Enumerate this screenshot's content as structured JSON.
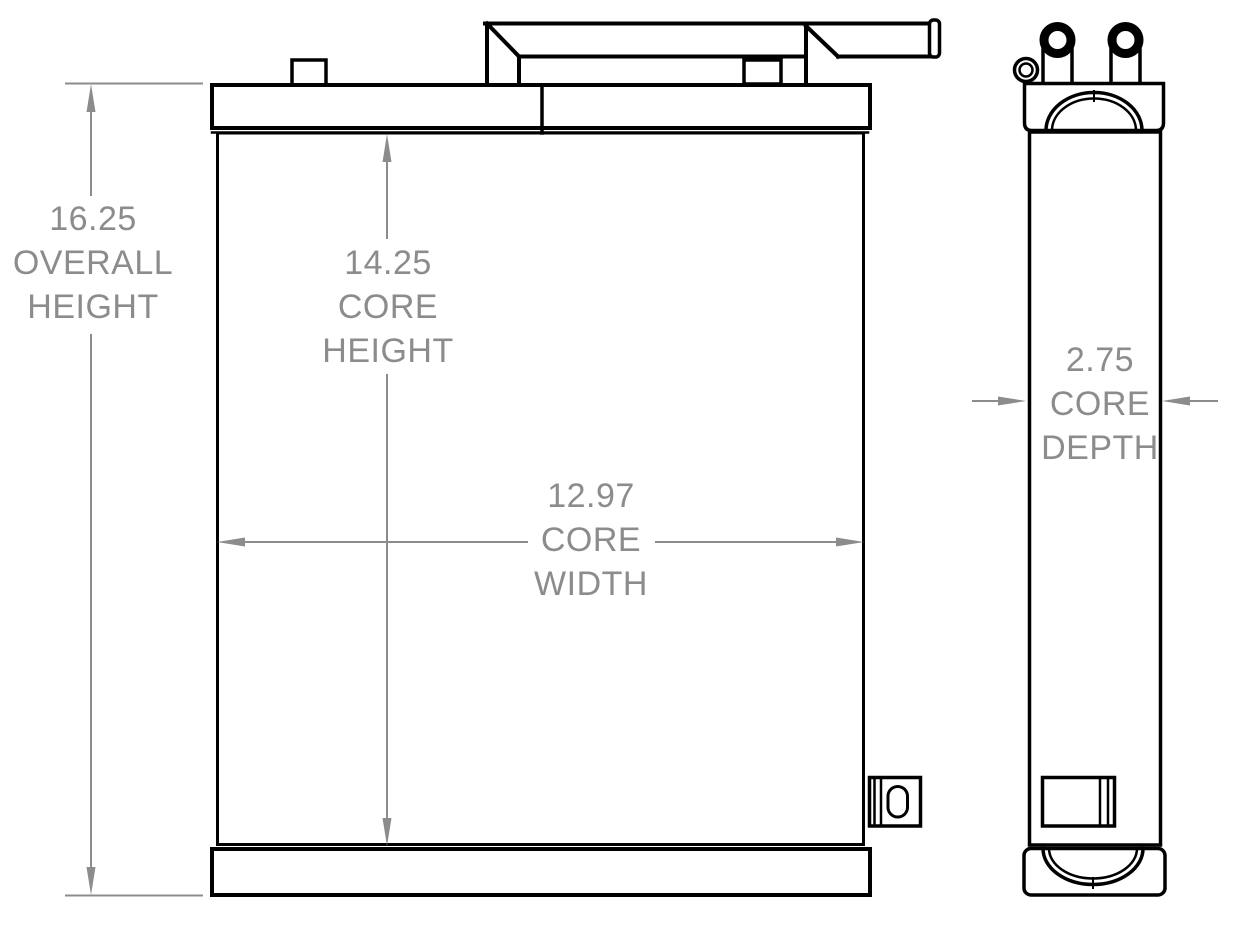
{
  "page": {
    "background": "#ffffff"
  },
  "drawing": {
    "type": "radiator-orthographic-views",
    "colors": {
      "outline": "#000000",
      "dimension": "#8c8c8c",
      "background": "#ffffff"
    },
    "dimensions": {
      "overall_height": {
        "value": "16.25",
        "label_line2": "OVERALL",
        "label_line3": "HEIGHT"
      },
      "core_height": {
        "value": "14.25",
        "label_line2": "CORE",
        "label_line3": "HEIGHT"
      },
      "core_width": {
        "value": "12.97",
        "label_line2": "CORE",
        "label_line3": "WIDTH"
      },
      "core_depth": {
        "value": "2.75",
        "label_line2": "CORE",
        "label_line3": "DEPTH"
      }
    }
  }
}
